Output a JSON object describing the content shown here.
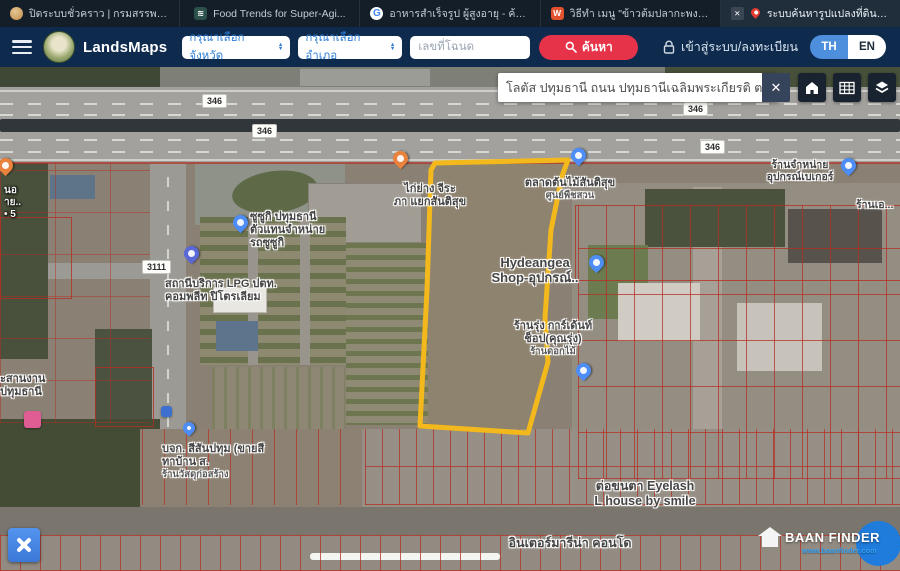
{
  "browser_tabs": [
    {
      "title": "ปิดระบบชั่วคราว | กรมสรรพากร...",
      "icon": "revenue-dept-coin"
    },
    {
      "title": "Food Trends for Super-Agi...",
      "icon": "food-site"
    },
    {
      "title": "อาหารสำเร็จรูป ผู้สูงอายุ - ค้นห...",
      "icon": "google"
    },
    {
      "title": "วิธีทำ เมนู \"ข้าวต้มปลากะพง\" เ...",
      "icon": "wongnai",
      "letter": "W"
    },
    {
      "title": "ระบบค้นหารูปแปลงที่ดิน (Land...",
      "icon": "map-pin",
      "active": true,
      "badge": "✕"
    }
  ],
  "header": {
    "app_name": "LandsMaps",
    "province_placeholder": "กรุณาเลือกจังหวัด",
    "district_placeholder": "กรุณาเลือกอำเภอ",
    "deed_placeholder": "เลขที่โฉนด",
    "search_label": "ค้นหา",
    "login_label": "เข้าสู่ระบบ/ลงทะเบียน",
    "lang_th": "TH",
    "lang_en": "EN"
  },
  "map": {
    "search_value": "โลตัส ปทุมธานี ถนน ปทุมธานีเฉลิมพระเกียรติ ต",
    "close_label": "✕",
    "road_badges": [
      "346",
      "346",
      "346",
      "346",
      "3111"
    ],
    "labels": {
      "grill_line1": "ไก่ย่าง จีระ",
      "grill_line2": "ภา แยกสันติสุข",
      "tree_market_line1": "ตลาดต้นไม้สันติสุข",
      "tree_market_line2": "ศูนย์พืชสวน",
      "suzuki_line1": "ซูซูกิ ปทุมธานี",
      "suzuki_line2": "ตัวแทนจำหน่าย",
      "suzuki_line3": "รถซูซูกิ",
      "lpg_line1": "สถานีบริการ LPG ปตท.",
      "lpg_line2": "คอมพลีท ปิโตรเลียม",
      "hydrangea_line1": "Hydeangea",
      "hydrangea_line2": "Shop-อุปกรณ์..",
      "garden_line1": "ร้านรุ่ง การ์เด้นท์",
      "garden_line2": "ช็อป(คุณรุ่ง)",
      "garden_line3": "ร้านดอกไม้",
      "bakery_line1": "ร้านจำหน่าย",
      "bakery_line2": "อุปกรณ์เบเกอร์",
      "shop_edge": "ร้านเอ...",
      "coord_line1": "ะสานงาน",
      "coord_line2": "ปทุมธานี",
      "edge_line1": "นอ",
      "edge_line2": "าย..",
      "edge_line3": "• 5",
      "paint_line1": "บจก. สีสันปทุม (ขายสี",
      "paint_line2": "ทาบ้าน ส.",
      "paint_line3": "ร้านวัสดุก่อสร้าง",
      "eyelash_line1": "ต่อขนตา Eyelash",
      "eyelash_line2": "L house by smile",
      "condo": "อินเตอร์มารีน่า คอนโด"
    },
    "watermark": {
      "brand": "BAAN FINDER",
      "url": "www.baanfinder.com"
    }
  },
  "colors": {
    "header_bg": "#0e2b4e",
    "tab_bar_bg": "#141e28",
    "accent_red": "#e6334a",
    "accent_blue": "#4d8fdd",
    "parcel_outline": "#f3b81b",
    "cadastral_red": "#b52f23"
  }
}
